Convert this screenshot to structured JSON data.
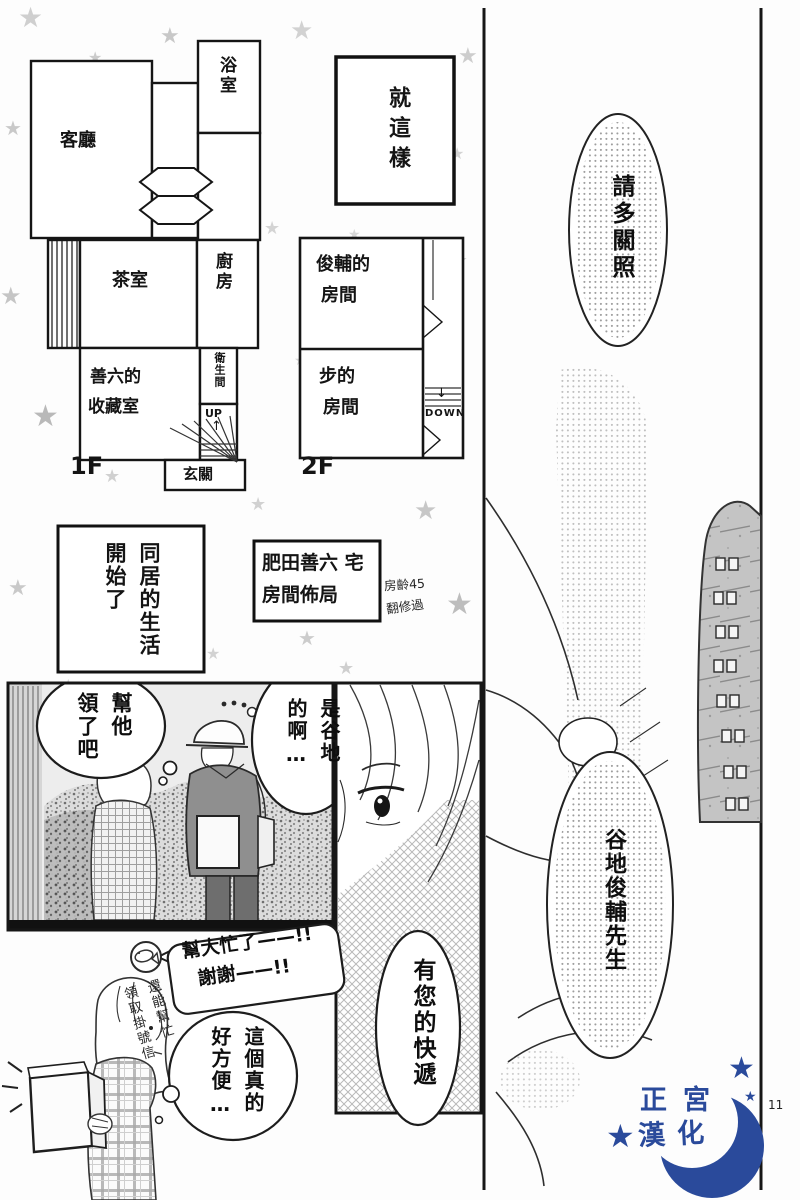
{
  "page_number": "11",
  "plans": {
    "f1": {
      "label": "1F",
      "bath": "浴室",
      "living": "客廳",
      "tea": "茶室",
      "kitchen": "廚房",
      "collection1": "善六的",
      "collection2": "收藏室",
      "toilet": "衛生間",
      "up": "UP",
      "up_arrow": "↑",
      "entrance": "玄關"
    },
    "f2": {
      "label": "2F",
      "room1a": "俊輔的",
      "room1b": "房間",
      "room2a": "步的",
      "room2b": "房間",
      "down_arrow": "↓",
      "down": "DOWN"
    }
  },
  "captions": {
    "just_so": "就這樣",
    "cohabit_col1": "同居的生活",
    "cohabit_col2": "開始了",
    "house_line1": "肥田善六 宅",
    "house_line2": "房間佈局",
    "house_note1": "房齡45",
    "house_note2": "翻修過"
  },
  "dialogue": {
    "please_care": "請多關照",
    "recipient_name": "谷地俊輔先生",
    "claim_col1": "幫他",
    "claim_col2": "領了吧",
    "yachi_col1": "是谷地",
    "yachi_col2": "的啊…",
    "thanks_line1": "幫大忙了——!!",
    "thanks_line2": "謝謝——!!",
    "mail_col1": "還能幫忙",
    "mail_col2": "領取掛號信",
    "delivery": "有您的快遞",
    "convenient_col1": "這個真的",
    "convenient_col2": "好方便…"
  },
  "logo": {
    "line1": "正宮",
    "line2": "漢化",
    "color": "#2a4a9b"
  }
}
